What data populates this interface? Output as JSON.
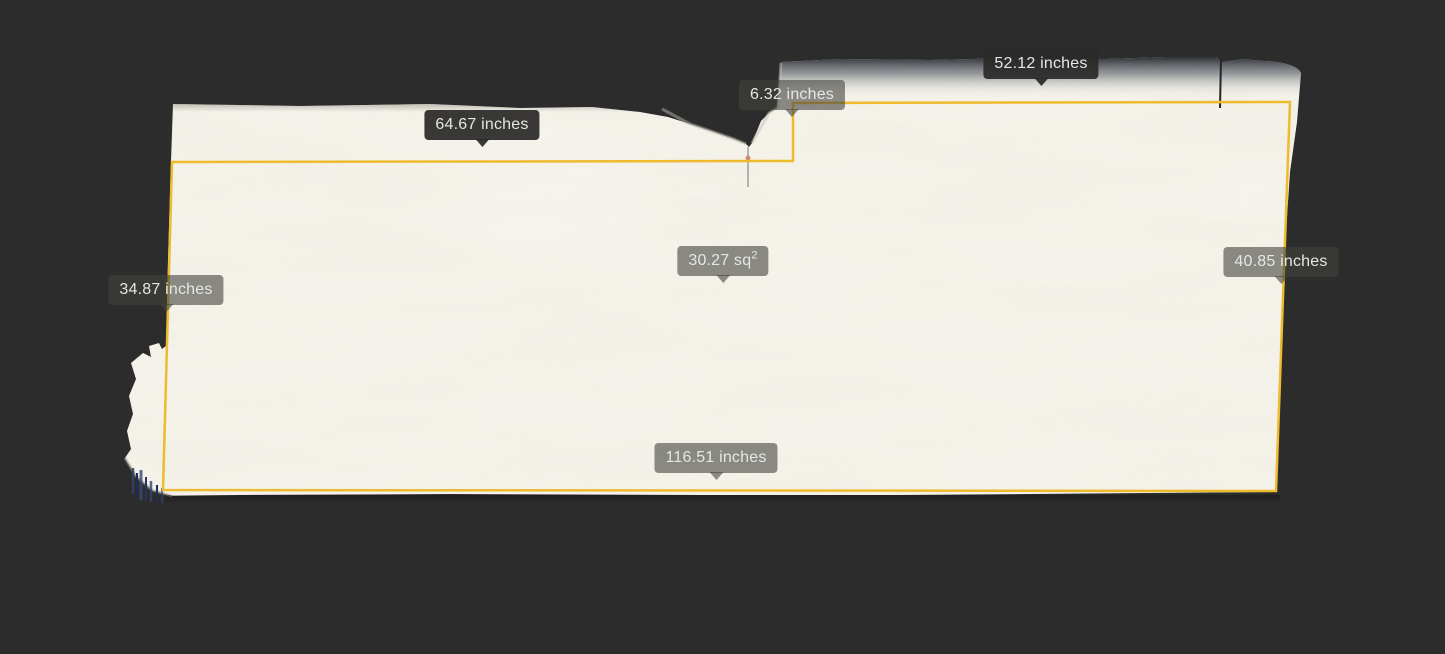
{
  "scene": {
    "background_color": "#2c2c2c",
    "slab_color": "#f6f4ec",
    "outline_color": "#eebb2e",
    "label_text_color": "#e6e6e4"
  },
  "measurements": {
    "top_left_width": {
      "label": "64.67 inches"
    },
    "top_right_width": {
      "label": "52.12 inches"
    },
    "step_height": {
      "label": "6.32 inches"
    },
    "left_height": {
      "label": "34.87 inches"
    },
    "right_height": {
      "label": "40.85 inches"
    },
    "bottom_width": {
      "label": "116.51 inches"
    },
    "area": {
      "value": "30.27 sq",
      "superscript": "2"
    }
  }
}
